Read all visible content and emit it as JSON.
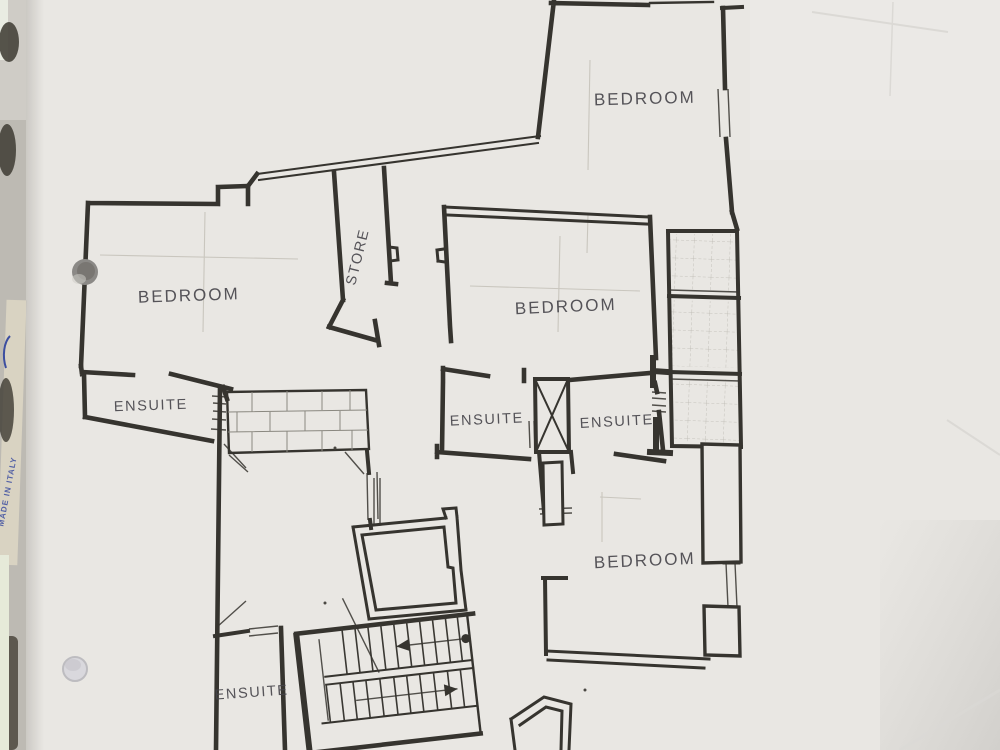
{
  "document_type": "architectural floor plan photograph",
  "colors": {
    "paper": "#e9e7e3",
    "ink": "#36342f",
    "ink2": "#45444a",
    "faint": "#c9c6be",
    "blue": "#3c4ea0",
    "crease": "#dbd9d5"
  },
  "labels": [
    {
      "id": "bedroom-top",
      "text": "BEDROOM"
    },
    {
      "id": "bedroom-left",
      "text": "BEDROOM"
    },
    {
      "id": "bedroom-middle",
      "text": "BEDROOM"
    },
    {
      "id": "bedroom-bottom",
      "text": "BEDROOM"
    },
    {
      "id": "ensuite-left",
      "text": "ENSUITE"
    },
    {
      "id": "ensuite-middle-left",
      "text": "ENSUITE"
    },
    {
      "id": "ensuite-middle-right",
      "text": "ENSUITE"
    },
    {
      "id": "ensuite-bottom",
      "text": "ENSUITE"
    },
    {
      "id": "store",
      "text": "STORE"
    }
  ],
  "edge_text": {
    "made_in_italy": "MADE IN ITALY"
  }
}
